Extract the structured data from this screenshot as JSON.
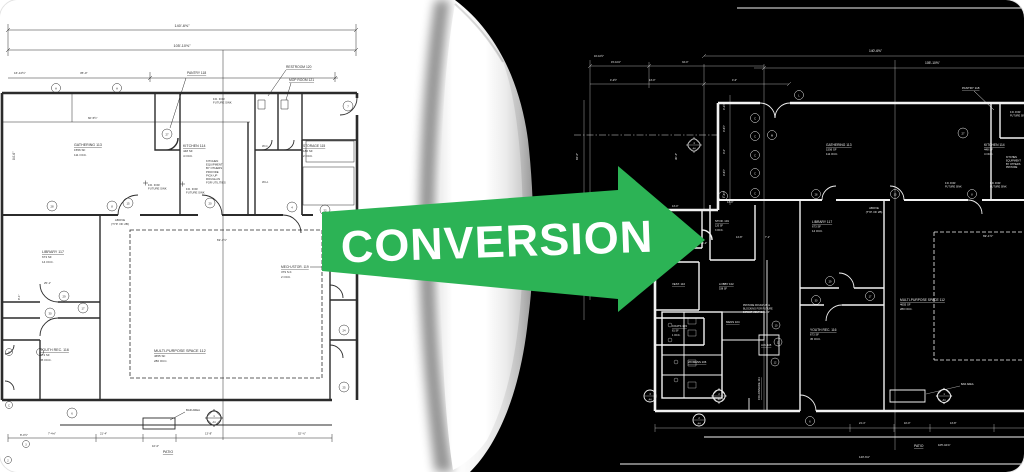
{
  "title": "Paper drawing to CAD conversion graphic",
  "arrow": {
    "label": "CONVERSION"
  },
  "colors": {
    "arrow_green": "#2CB355",
    "arrow_text": "#ffffff",
    "paper": "#ffffff",
    "dark_bg": "#000000",
    "left_ink": "#2b2b2b",
    "right_ink": "#f2f2f2"
  },
  "rooms": {
    "gathering": {
      "label": "GATHERING  113",
      "sf": "1556 SF",
      "occ": "111 OCC."
    },
    "kitchen": {
      "label": "KITCHEN  114",
      "sf": "448 SF",
      "occ": "4 OCC."
    },
    "pantry": {
      "label": "PANTRY  118"
    },
    "restroom": {
      "label": "RESTROOM  120"
    },
    "mop": {
      "label": "MOP ROOM  121"
    },
    "storage": {
      "label": "STORAGE  115",
      "sf": "180 SF",
      "occ": "2 OCC."
    },
    "library": {
      "label": "LIBRARY  117",
      "sf": "673 SF",
      "occ": "14 OCC."
    },
    "youth": {
      "label": "YOUTH REC.  116",
      "sf": "673 SF",
      "occ": "45 OCC."
    },
    "multi": {
      "label": "MULTI-PURPOSE SPACE  112",
      "sf": "4655 SF",
      "occ": "280 OCC."
    },
    "mech": {
      "label": "MECH./STOR.  119",
      "sf": "379 S.F.",
      "occ": "2 OCC."
    },
    "vest": {
      "label": "VEST.  110"
    },
    "lobby": {
      "label": "LOBBY  102",
      "sf": "538 SF"
    },
    "coats": {
      "label": "COATS  103",
      "sf": "81 SF",
      "occ": "1 OCC."
    },
    "mens": {
      "label": "MENS  104"
    },
    "jan": {
      "label": "JAN.  105"
    },
    "womens": {
      "label": "WOMENS  106"
    },
    "cntrl": {
      "label": "CNTRL RM  108"
    },
    "stor101": {
      "label": "STOR.  101",
      "sf": "120 SF",
      "occ": "3 OCC."
    },
    "colonnade": {
      "label": "COLONNADE  111"
    },
    "wc": "W.C.",
    "wh": "W.H."
  },
  "notes": {
    "above1": "ABOVE",
    "above2": "(TYP. OF 2B)",
    "patio": "PATIO",
    "bar": "BAR AREA",
    "fd1": "F.D. FOR",
    "fd2": "FUTURE SINK",
    "kitchen_note": [
      "KITCHEN",
      "EQUIPMENT",
      "BY OTHERS",
      "PROVIDE",
      "PICK-UP",
      "ROUGH-IN",
      "FOR UTILITIES"
    ],
    "provide_note": [
      "PROVIDE ROUGH-IN &",
      "BLOCKING FOR FUTURE",
      "DIRECT VENT GAS FP"
    ]
  },
  "dims": {
    "d140": "140'-6⅝\"",
    "d105": "105'-10⅝\"",
    "d69": "69'-1½\"",
    "d60": "60'-5½\"",
    "d84": "84'-6\"",
    "d16": "16'-10½\"",
    "d35": "35'-0\"",
    "d25": "25'-1\"",
    "d21": "21'-4\"",
    "d10": "10'-0\"",
    "d13": "13'-8\"",
    "d52": "52'-½\"",
    "d7": "7'-4⅝\"",
    "d80": "8'-0½\"",
    "d81": "8'-1\"",
    "d30": "30'-4\"",
    "d34": "34'-0\"",
    "d15": "15'-10⅝\"",
    "d130": "13'-0\"",
    "d42": "4'-2½\"",
    "d46": "4'-6½\"",
    "d40": "4'-0\"",
    "d162": "1'-6½\"",
    "d71": "7'-1\"",
    "d148": "14'-8\"",
    "d112": "11'-2\""
  },
  "bubbles": {
    "n1": "1",
    "n2": "2",
    "n3": "3",
    "n4": "4",
    "n6": "6",
    "n7": "7",
    "n8": "8",
    "n10": "10",
    "n11": "11",
    "n12": "12",
    "n15": "15",
    "n17": "17",
    "n20": "20",
    "n22": "22",
    "n24": "24",
    "n25": "25",
    "n27": "27",
    "n28": "28",
    "n29": "29",
    "n30": "30",
    "a": "A",
    "c": "C",
    "l": "L",
    "m": "M",
    "a4": "A4"
  }
}
